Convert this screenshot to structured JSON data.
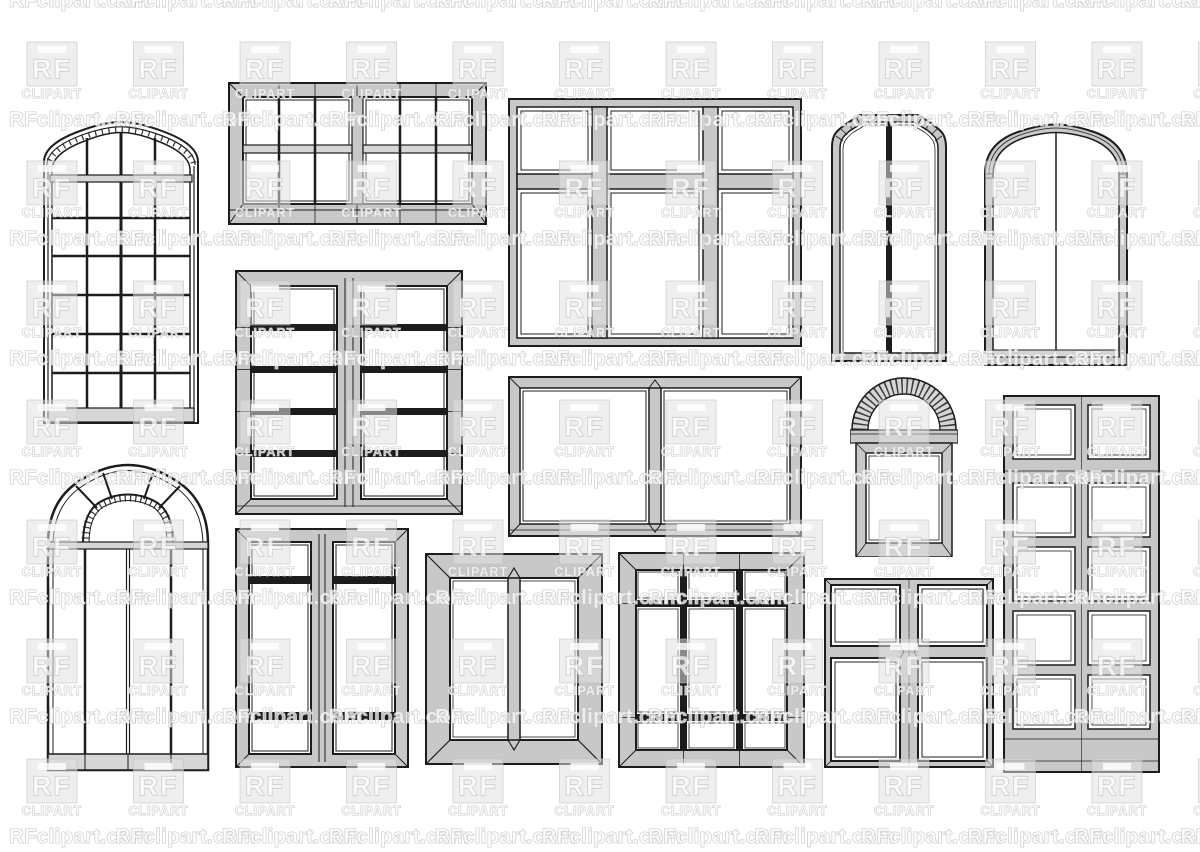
{
  "page": {
    "width": 1200,
    "height": 852,
    "background": "#ffffff"
  },
  "watermark": {
    "site_text": "RFclipart.com",
    "logo_top": "RF",
    "logo_bottom": "CLIPART",
    "fill_color": "#ffffff",
    "outline_color": "#bdbdbd",
    "logo_box_color": "#e2e2e2",
    "grid": {
      "x_start": 9,
      "x_period": 106.5,
      "logo_x_start": 27,
      "per_row": 12,
      "text_baselines": [
        7,
        126,
        245,
        365,
        484,
        604,
        723,
        843
      ],
      "logo_rows": [
        42,
        161,
        281,
        400,
        520,
        639,
        759
      ]
    }
  },
  "illustration": {
    "line_color": "#1c1c1c",
    "frame_fill": "#c8c8c8",
    "glass_fill": "#ffffff",
    "windows": [
      {
        "id": "w1",
        "label": "arched multi-pane grid window"
      },
      {
        "id": "w2",
        "label": "double sash window, six panes per sash"
      },
      {
        "id": "w3",
        "label": "three-column window with transom"
      },
      {
        "id": "w4",
        "label": "tall window with chamfered top corners"
      },
      {
        "id": "w5",
        "label": "arched two-pane window"
      },
      {
        "id": "w6",
        "label": "double casement window, five panes per sash"
      },
      {
        "id": "w7",
        "label": "two-pane picture window"
      },
      {
        "id": "w8",
        "label": "window with brick arch top"
      },
      {
        "id": "w9",
        "label": "tall ten-pane window"
      },
      {
        "id": "w10",
        "label": "arched fanlight window"
      },
      {
        "id": "w11",
        "label": "double casement window, three panes per sash"
      },
      {
        "id": "w12",
        "label": "thick-frame two-pane window"
      },
      {
        "id": "w13",
        "label": "nine-pane window"
      },
      {
        "id": "w14",
        "label": "four-pane cross window"
      }
    ]
  }
}
